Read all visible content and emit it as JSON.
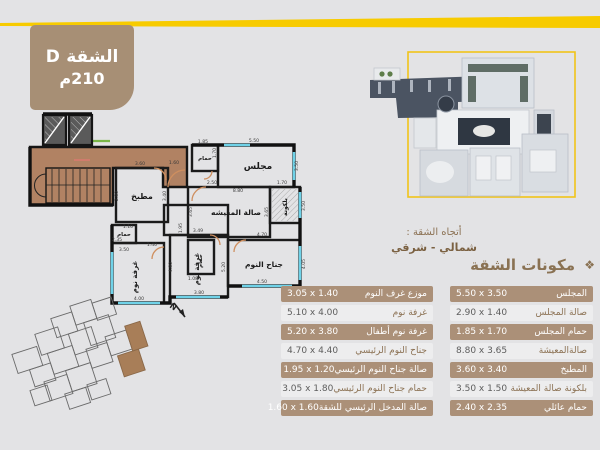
{
  "banner": {
    "line1": "الشقة D",
    "line2": "210م"
  },
  "direction": {
    "label": "أتجاه الشقة :",
    "value": "شمالي - شرقي"
  },
  "components": {
    "header": "مكونات الشقة",
    "header_icon": "❖",
    "right_table": [
      {
        "label": "المجلس",
        "value": "5.50 x 3.50"
      },
      {
        "label": "صالة المجلس",
        "value": "2.90 x 1.40"
      },
      {
        "label": "حمام المجلس",
        "value": "1.85 x 1.70"
      },
      {
        "label": "صالةالمعيشة",
        "value": "8.80 x 3.65"
      },
      {
        "label": "المطبخ",
        "value": "3.60 x 3.40"
      },
      {
        "label": "بلكونة صالة المعيشة",
        "value": "3.50 x 1.50"
      },
      {
        "label": "حمام عائلي",
        "value": "2.40 x 2.35"
      }
    ],
    "left_table": [
      {
        "label": "موزع غرف النوم",
        "value": "3.05 x 1.40"
      },
      {
        "label": "غرفة نوم",
        "value": "5.10 x 4.00"
      },
      {
        "label": "غرفة نوم أطفال",
        "value": "5.20 x 3.80"
      },
      {
        "label": "جناح النوم الرئيسي",
        "value": "4.70 x 4.40"
      },
      {
        "label": "صالة جناح النوم الرئيسي",
        "value": "1.95 x 1.20"
      },
      {
        "label": "حمام جناح النوم الرئيسي",
        "value": "3.05 x 1.80"
      },
      {
        "label": "صالة المدخل الرئيسي للشقة",
        "value": "1.60 x 1.60"
      }
    ]
  },
  "floorplan": {
    "north_label": "N",
    "room_labels": [
      {
        "t": "مجلس",
        "x": 252,
        "y": 69,
        "s": 9,
        "r": 0
      },
      {
        "t": "مطبخ",
        "x": 136,
        "y": 99,
        "s": 8,
        "r": 0
      },
      {
        "t": "صالة المعيشه",
        "x": 230,
        "y": 115,
        "s": 7.5,
        "r": 0
      },
      {
        "t": "بلكونة",
        "x": 281,
        "y": 107,
        "s": 6,
        "r": -90
      },
      {
        "t": "جناح النوم",
        "x": 258,
        "y": 167,
        "s": 7.5,
        "r": 0
      },
      {
        "t": "غرفة نوم",
        "x": 193,
        "y": 169,
        "s": 7,
        "r": -90
      },
      {
        "t": "غرفة نوم",
        "x": 131,
        "y": 177,
        "s": 7,
        "r": -90
      },
      {
        "t": "حمام",
        "x": 199,
        "y": 60,
        "s": 5.5,
        "r": 0
      },
      {
        "t": "حمام",
        "x": 196,
        "y": 161,
        "s": 5.5,
        "r": -90
      },
      {
        "t": "حمام",
        "x": 118,
        "y": 136,
        "s": 5.5,
        "r": 0
      }
    ],
    "dims": [
      {
        "t": "5.50",
        "x": 248,
        "y": 42,
        "r": 0
      },
      {
        "t": "3.50",
        "x": 292,
        "y": 66,
        "r": -90
      },
      {
        "t": "2.50",
        "x": 206,
        "y": 84,
        "r": 0
      },
      {
        "t": "8.80",
        "x": 232,
        "y": 92,
        "r": 0
      },
      {
        "t": "3.65",
        "x": 186,
        "y": 112,
        "r": -90
      },
      {
        "t": "3.65",
        "x": 262,
        "y": 112,
        "r": -90
      },
      {
        "t": "1.70",
        "x": 276,
        "y": 84,
        "r": 0
      },
      {
        "t": "3.50",
        "x": 299,
        "y": 106,
        "r": -90
      },
      {
        "t": "3.60",
        "x": 134,
        "y": 65,
        "r": 0
      },
      {
        "t": "2.80",
        "x": 112,
        "y": 96,
        "r": -90
      },
      {
        "t": "3.40",
        "x": 160,
        "y": 96,
        "r": -90
      },
      {
        "t": "1.85",
        "x": 197,
        "y": 43,
        "r": 0
      },
      {
        "t": "1.70",
        "x": 210,
        "y": 53,
        "r": -90
      },
      {
        "t": "1.60",
        "x": 168,
        "y": 64,
        "r": 0
      },
      {
        "t": "4.70",
        "x": 256,
        "y": 136,
        "r": 0
      },
      {
        "t": "4.50",
        "x": 256,
        "y": 183,
        "r": 0
      },
      {
        "t": "4.05",
        "x": 299,
        "y": 164,
        "r": -90
      },
      {
        "t": "3.49",
        "x": 192,
        "y": 132,
        "r": 0
      },
      {
        "t": "4.80",
        "x": 166,
        "y": 167,
        "r": -90
      },
      {
        "t": "3.80",
        "x": 193,
        "y": 194,
        "r": 0
      },
      {
        "t": "5.20",
        "x": 219,
        "y": 167,
        "r": -90
      },
      {
        "t": "3.50",
        "x": 118,
        "y": 151,
        "r": 0
      },
      {
        "t": "4.00",
        "x": 133,
        "y": 200,
        "r": 0
      },
      {
        "t": "2.35",
        "x": 111,
        "y": 141,
        "r": 0
      },
      {
        "t": "1.10",
        "x": 122,
        "y": 128,
        "r": 0
      },
      {
        "t": "1.95",
        "x": 176,
        "y": 128,
        "r": -90
      },
      {
        "t": "1.40",
        "x": 146,
        "y": 146,
        "r": 0
      },
      {
        "t": "1.08",
        "x": 187,
        "y": 180,
        "r": 0
      }
    ]
  }
}
